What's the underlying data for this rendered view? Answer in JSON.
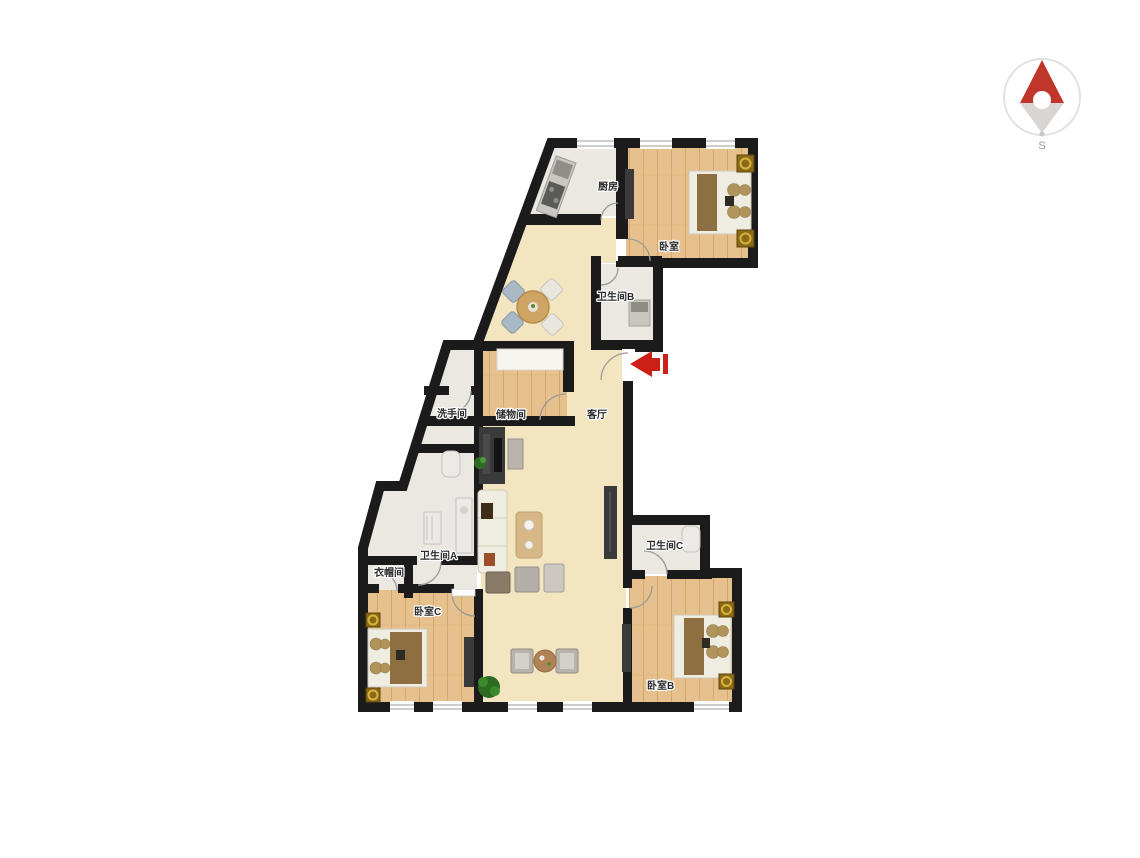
{
  "page": {
    "background": "#ffffff"
  },
  "compass": {
    "south_label": "S",
    "needle_color": "#c1362a",
    "ring_color": "#e3e0e0",
    "tail_color": "#d8d5d3"
  },
  "entrance": {
    "arrow_color": "#cc2016"
  },
  "floorplan": {
    "rooms": {
      "kitchen": {
        "label": "厨房"
      },
      "master_bedroom": {
        "label": "卧室"
      },
      "bathroom_b": {
        "label": "卫生间B"
      },
      "living_room": {
        "label": "客厅"
      },
      "storage_room": {
        "label": "储物间"
      },
      "washroom": {
        "label": "洗手间"
      },
      "bathroom_a": {
        "label": "卫生间A"
      },
      "cloakroom": {
        "label": "衣帽间"
      },
      "bedroom_c": {
        "label": "卧室C"
      },
      "bathroom_c": {
        "label": "卫生间C"
      },
      "bedroom_b": {
        "label": "卧室B"
      }
    },
    "colors": {
      "wall": "#1b1b1b",
      "wood_floor": "#e7c18d",
      "wood_seam": "#d4a76b",
      "beige_floor": "#f4e5c1",
      "tile_floor": "#eae8e1",
      "dark_furniture": "#3a3a3a",
      "bed_sheet": "#efece2",
      "bed_blanket": "#8d6f42",
      "pillow": "#b1945c",
      "nightstand_gold": "#8a6a18"
    }
  }
}
